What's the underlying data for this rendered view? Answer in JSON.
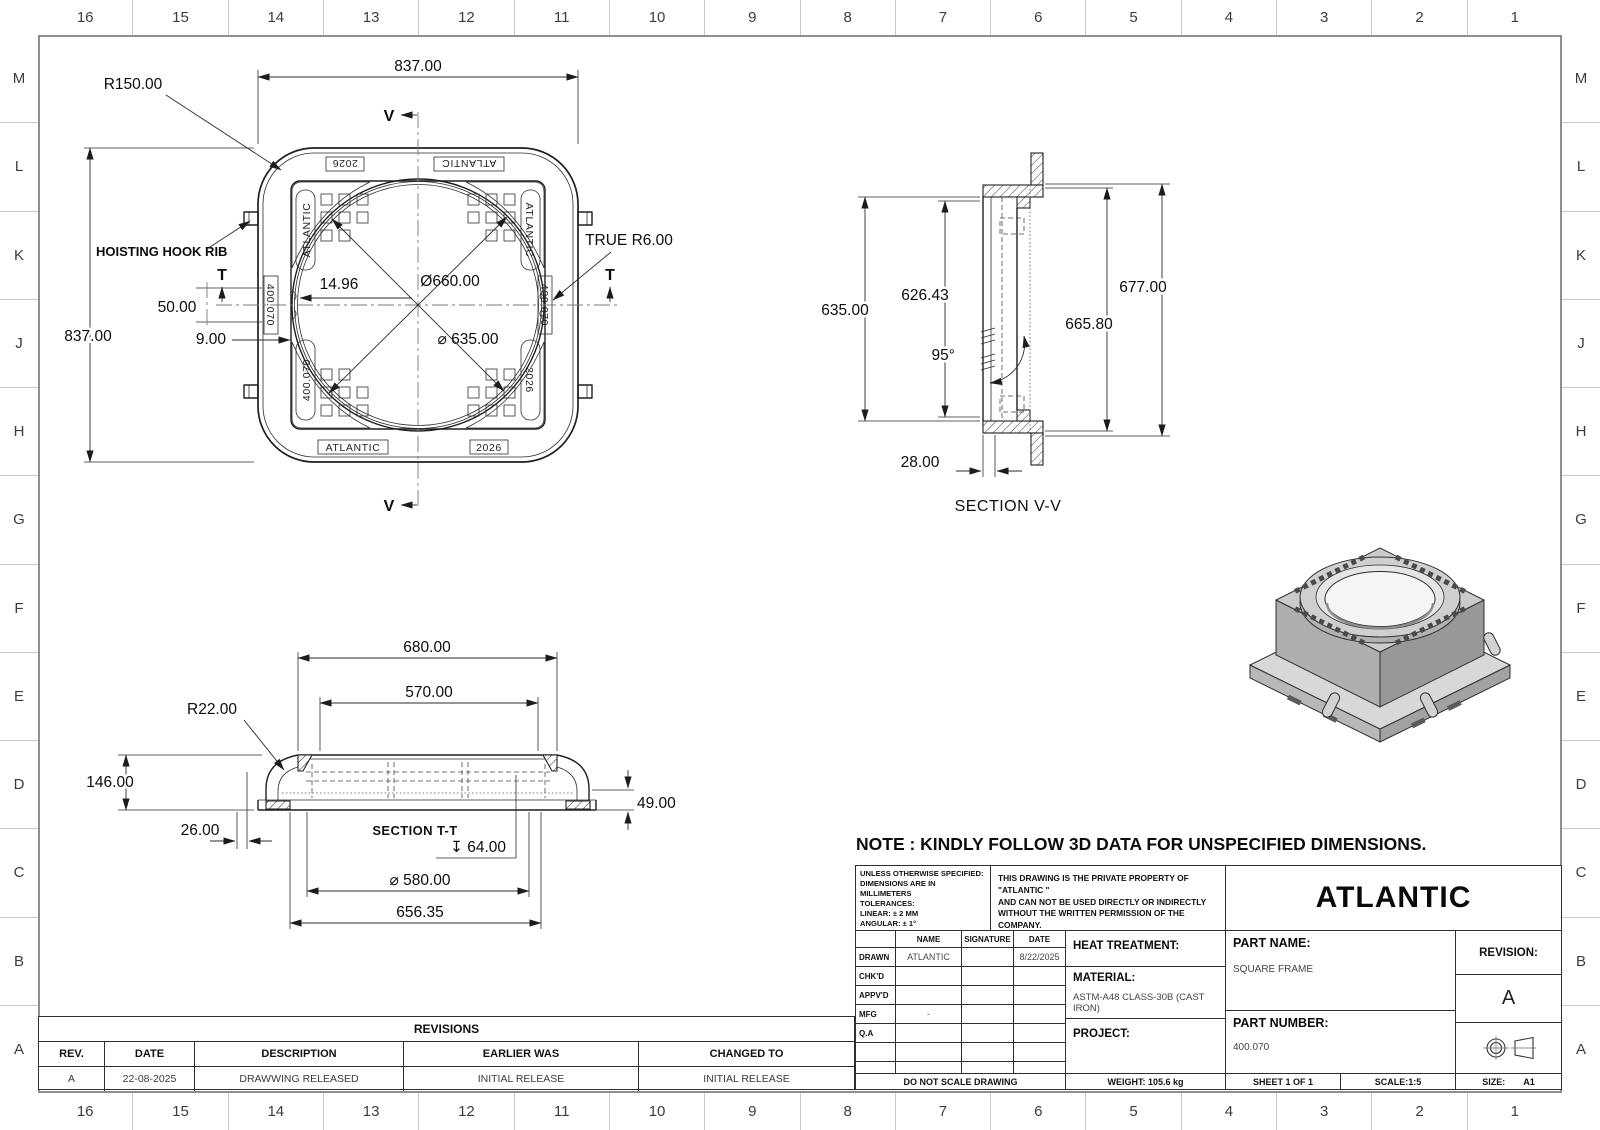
{
  "sheet": {
    "frame_color": "#8f8f8f",
    "line_color": "#1f1f1f",
    "accent": "#0c0c0c"
  },
  "border": {
    "columns": [
      "16",
      "15",
      "14",
      "13",
      "12",
      "11",
      "10",
      "9",
      "8",
      "7",
      "6",
      "5",
      "4",
      "3",
      "2",
      "1"
    ],
    "rows": [
      "M",
      "L",
      "K",
      "J",
      "H",
      "G",
      "F",
      "E",
      "D",
      "C",
      "B",
      "A"
    ]
  },
  "note": "NOTE : KINDLY FOLLOW 3D DATA FOR UNSPECIFIED DIMENSIONS.",
  "views": {
    "top": {
      "dims": {
        "width_top": "837.00",
        "height_left": "837.00",
        "corner_radius": "R150.00",
        "outer_dia": "Ø660.00",
        "inner_dia": "⌀ 635.00",
        "seat_offset": "14.96",
        "tab_offset": "50.00",
        "rib_width": "9.00",
        "true_radius": "TRUE R6.00"
      },
      "labels": {
        "hoisting_hook": "HOISTING HOOK RIB",
        "section_v": "V",
        "section_t": "T"
      },
      "engravings": {
        "year": "2026",
        "brand": "ATLANTIC",
        "part_no": "400.070"
      }
    },
    "section_vv": {
      "title": "SECTION V-V",
      "dims": {
        "inner_height": "635.00",
        "seat_height": "626.43",
        "overall_height": "677.00",
        "mid_height": "665.80",
        "angle": "95°",
        "flange": "28.00"
      }
    },
    "section_tt": {
      "title": "SECTION T-T",
      "dims": {
        "top_width": "680.00",
        "inner_width": "570.00",
        "corner_radius": "R22.00",
        "height": "146.00",
        "base_inset": "26.00",
        "base_height": "49.00",
        "depth": "↧ 64.00",
        "dia": "⌀ 580.00",
        "outer_width": "656.35"
      }
    }
  },
  "revisions": {
    "title": "REVISIONS",
    "headers": [
      "REV.",
      "DATE",
      "DESCRIPTION",
      "EARLIER WAS",
      "CHANGED TO"
    ],
    "rows": [
      [
        "A",
        "22-08-2025",
        "DRAWWING RELEASED",
        "INITIAL RELEASE",
        "INITIAL RELEASE"
      ]
    ]
  },
  "title_block": {
    "tolerances": [
      "UNLESS OTHERWISE SPECIFIED:",
      "DIMENSIONS ARE IN MILLIMETERS",
      "TOLERANCES:",
      "LINEAR: ± 2 MM",
      "ANGULAR: ± 1°",
      "BRK/FILE SHARP CORNER: 1 MM MAX",
      "SURFACE FINISH: 20 - 50"
    ],
    "property_notice": [
      "THIS DRAWING IS THE PRIVATE PROPERTY OF \"ATLANTIC \"",
      "AND CAN NOT BE USED DIRECTLY OR INDIRECTLY",
      "WITHOUT THE WRITTEN PERMISSION  OF THE COMPANY.",
      "ALL LEGAL RIGHTS RESERVED."
    ],
    "company": "ATLANTIC",
    "signoff": {
      "headers": [
        "",
        "NAME",
        "SIGNATURE",
        "DATE"
      ],
      "rows": [
        [
          "DRAWN",
          "ATLANTIC",
          "",
          "8/22/2025"
        ],
        [
          "CHK'D",
          "",
          "",
          ""
        ],
        [
          "APPV'D",
          "",
          "",
          ""
        ],
        [
          "MFG",
          "-",
          "",
          ""
        ],
        [
          "Q.A",
          "",
          "",
          ""
        ],
        [
          "",
          "",
          "",
          ""
        ],
        [
          "",
          "",
          "",
          ""
        ]
      ]
    },
    "heat_treatment_label": "HEAT TREATMENT:",
    "material_label": "MATERIAL:",
    "material_value": "ASTM-A48 CLASS-30B (CAST IRON)",
    "project_label": "PROJECT:",
    "part_name_label": "PART NAME:",
    "part_name_value": "SQUARE FRAME",
    "part_number_label": "PART NUMBER:",
    "part_number_value": "400.070",
    "revision_label": "REVISION:",
    "revision_value": "A",
    "do_not_scale": "DO NOT SCALE DRAWING",
    "weight": "WEIGHT: 105.6 kg",
    "sheet": "SHEET 1 OF 1",
    "scale": "SCALE:1:5",
    "size_label": "SIZE:",
    "size_value": "A1"
  }
}
